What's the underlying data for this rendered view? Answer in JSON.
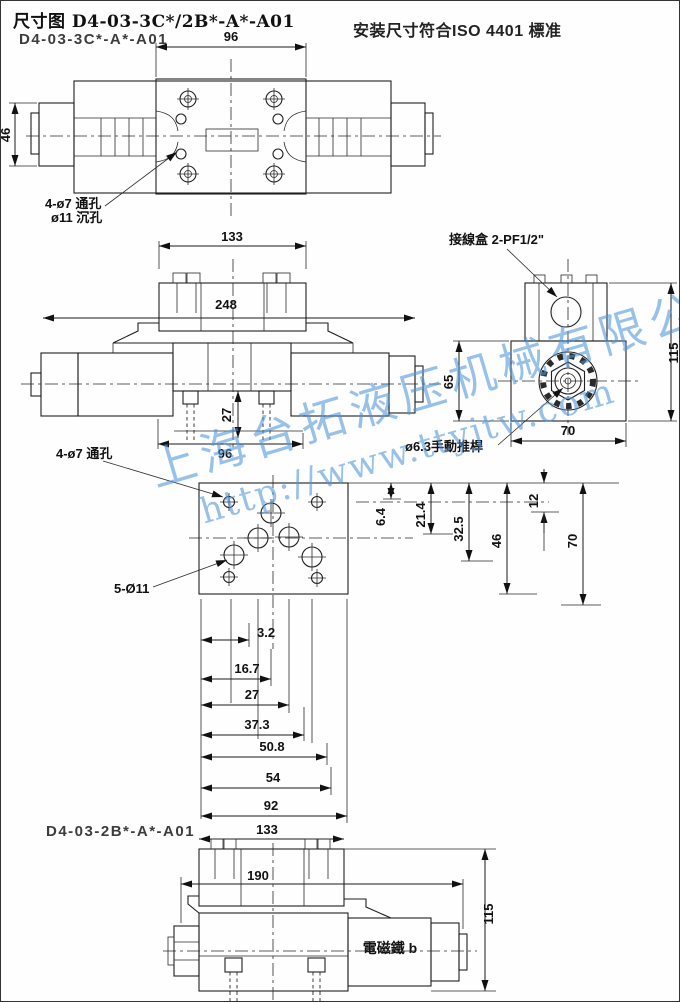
{
  "header": {
    "title": "尺寸图 D4-03-3C*/2B*-A*-A01",
    "subtitle": "D4-03-3C*-A*-A01",
    "standard": "安装尺寸符合ISO 4401 標准"
  },
  "watermark": {
    "company": "上海台拓液压机械有限公司",
    "url": "http://www.ttyjtw.com",
    "color": "#4d94d9"
  },
  "colors": {
    "line": "#1f1f1f",
    "background": "#fefefe"
  },
  "top_view": {
    "dim_flange_width": "96",
    "dim_height": "46",
    "callout_hole_line1": "4-ø7 通孔",
    "callout_hole_line2": "ø11 沉孔"
  },
  "side_view": {
    "dim_box_width": "133",
    "dim_total_length": "248",
    "dim_port_depth": "27",
    "dim_plate_width": "96"
  },
  "end_view": {
    "callout_junction_box": "接線盒 2-PF1/2\"",
    "callout_manual_pin": "ø6.3手動推桿",
    "dim_total_height": "115",
    "dim_body_height": "65",
    "dim_width": "70"
  },
  "plate_view": {
    "callout_through_holes": "4-ø7 通孔",
    "callout_port_holes": "5-Ø11",
    "vdims": [
      "6.4",
      "21.4",
      "32.5",
      "46",
      "12",
      "70"
    ],
    "hdims": [
      "3.2",
      "16.7",
      "27",
      "37.3",
      "50.8",
      "54",
      "92"
    ]
  },
  "bottom_view": {
    "label": "D4-03-2B*-A*-A01",
    "dim_box_width": "133",
    "dim_length": "190",
    "dim_height": "115",
    "solenoid_label": "電磁鐵 b"
  }
}
